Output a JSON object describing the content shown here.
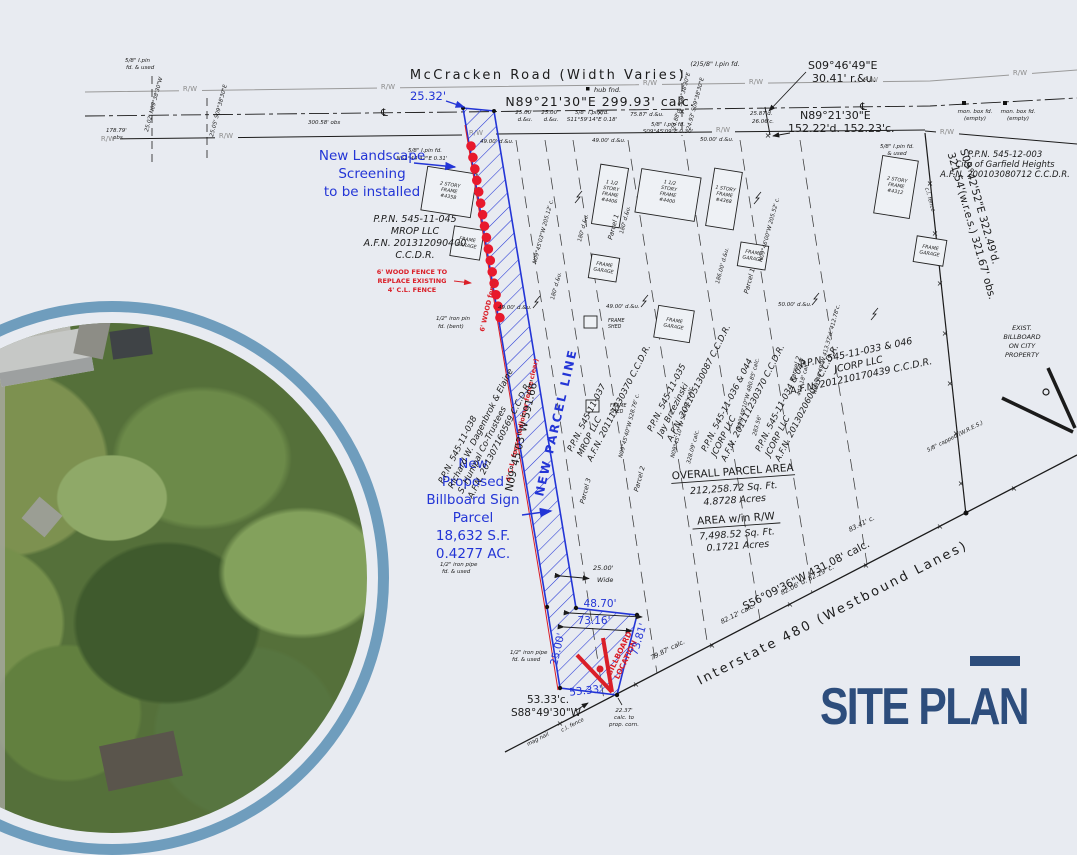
{
  "title": {
    "text": "SITE PLAN"
  },
  "road": {
    "name": "McCracken  Road  (Width Varies)",
    "bearing": "N89°21'30\"E  299.93' calc.",
    "rw": "R/W",
    "cl": "℄",
    "hub": "hub fnd.",
    "pin2": "(2)5/8\" I.pin fd.",
    "se1": "S09°46'49\"E",
    "se2": "30.41' r.&u.",
    "e1": "N89°21'30\"E",
    "e2": "152.22'd.  152.23'c.",
    "d25": "25.00'",
    "du": "d.&u.",
    "pin_s11": [
      "5/8\" I.pin fd.",
      "S11°59'14\"E 0.18'"
    ],
    "d7587": "75.87' d.&u.",
    "pin_s09": [
      "5/8\" I.pin fd.",
      "S09°45'09\"E 0.30'"
    ],
    "d2587": [
      "25.87'd.",
      "26.06'c."
    ],
    "r2488": "24.88'd. S09°38'30\"E",
    "r2493": "24.93' S09°38'30\"E",
    "d49": "49.00' d.&u.",
    "d50": "50.00' d.&u.",
    "pin_n51": [
      "5/8\" I.pin fd.",
      "N51°44'42\"E 0.31'"
    ],
    "mon": [
      "mon. box fd.",
      "(empty)"
    ],
    "pin_used": [
      "5/8\" I.pin fd.",
      "& used"
    ]
  },
  "left": {
    "pin": [
      "5/8\" I.pin",
      "fd. & used"
    ],
    "r2502": "25.02' N09°38'30\"W",
    "r2505": "25.05' S09°38'30\"E",
    "d17879": [
      "178.79'",
      "obs"
    ],
    "d30058": "300.58' obs"
  },
  "blue": {
    "d2532": "25.32'",
    "landscape": [
      "New Landscape",
      "Screening",
      "to be installed"
    ],
    "npl": "NEW PARCEL LINE",
    "proposed": [
      "New",
      "Proposed",
      "Billboard Sign",
      "Parcel",
      "18,632 S.F.",
      "0.4277 AC."
    ],
    "d4870": "48.70'",
    "d7316": "73.16'",
    "d7381": "73.81'",
    "d2500": "25.00'",
    "d5333": "53.33'"
  },
  "red": {
    "note": [
      "6' WOOD FENCE TO",
      "REPLACE EXISTING",
      "4' C.L. FENCE"
    ],
    "bb": [
      "BILLBOARD",
      "LOCATION"
    ],
    "f1": "6' WOOD fence",
    "f2": "4' C.L. fence (adjoiner fence clear)"
  },
  "parcels": {
    "p045": [
      "P.P.N. 545-11-045",
      "MROP LLC",
      "A.F.N. 201312090400",
      "C.C.D.R."
    ],
    "p038": [
      "P.P.N. 545-11-038",
      "Richard W. Dagenbrok & Elaine",
      "S. Humpal Co-Trustees",
      "A.F.N. 201307160569 C.C.D.R."
    ],
    "p037": [
      "P.P.N. 545-11-037",
      "MROP LLC",
      "A.F.N. 201111230370 C.C.D.R."
    ],
    "p035": [
      "P.P.N. 545-11-035",
      "Jay Brzezinski",
      "A.F.N. 201105130087 C.C.D.R."
    ],
    "p036": [
      "P.P.N. 545-11-036 & 044",
      "JCORP LLC",
      "A.F.N. 201111230370 C.C.D.R."
    ],
    "p034": [
      "P.P.N. 545-11-034 & 042",
      "JCORP LLC",
      "A.F.N. 201302060013 C.C.D.R."
    ],
    "p033": [
      "P.P.N. 545-11-033 & 046",
      "JCORP LLC",
      "A.F.N. 201210170439 C.C.D.R."
    ],
    "p003": [
      "P.P.N. 545-12-003",
      "City of Garfield Heights",
      "A.F.N. 200103080712 C.C.D.R."
    ],
    "parcel1": "Parcel 1",
    "parcel2": "Parcel 2",
    "parcel3": "Parcel 3"
  },
  "llabels": {
    "n0945_205": "N09°45'03\"W 205.12' c.",
    "d180": "180' d.&u.",
    "d186": "186.00' d.&u.",
    "n0946_205": "N09°46'00\"W 205.52' c.",
    "n0945_528": "N09°45'40\"W 528.76' c.",
    "n0945_534": "N09°45'10\"W 534.41' calc.",
    "c32809": "328.09' calc.",
    "n0949_480": "N09°49'10\"W 480.85' calc.",
    "n0946_413": "N09°46'49\"W 413.37'd. 412.78'c.",
    "c44318": "443.18' calc.",
    "c28356": "283.56'",
    "strip_bearing": "N09°45'03\"W  591.66'"
  },
  "areas": {
    "title": "OVERALL PARCEL AREA",
    "sqft": "212,258.72 Sq. Ft.",
    "acres": "4.8728 Acres",
    "rw_title": "AREA w/in R/W",
    "rw_sqft": "7,498.52 Sq. Ft.",
    "rw_acres": "0.1721 Acres"
  },
  "highway": {
    "name": "Interstate  480  (Westbound Lanes)",
    "bearing": "S56°09'36\"W  431.08' calc.",
    "t7987": "79.87' calc.",
    "t8212": "82.12' calc.",
    "t8206": "82.06' d.  82.29' c.",
    "t8341": "83.41' c."
  },
  "right": {
    "bearing1": "S09°42'52\"E  322.49'd.",
    "bearing2": "321.54'(w.r.e.s.)  321.67' obs.",
    "capped": "5/8\" capped (W.R.E.S.)",
    "exist": [
      "EXIST.",
      "BILLBOARD",
      "ON CITY",
      "PROPERTY"
    ]
  },
  "bottom": {
    "d5333c": "53.33'c.",
    "s88": "S88°49'30\"W",
    "mag": "mag nail",
    "clfence": "c.l. fence",
    "t2237": [
      "22.37'",
      "calc. to",
      "prop. corn."
    ],
    "pipe1": [
      "1/2\" iron pipe",
      "fd. & used"
    ],
    "pin_bent": [
      "1/2\" iron pin",
      "fd. (bent)"
    ],
    "d2500w": [
      "25.00'",
      "Wide"
    ]
  },
  "bld": {
    "h1": [
      "2 STORY",
      "FRAME",
      "#4358"
    ],
    "h2": [
      "1 1/2",
      "STORY",
      "FRAME",
      "#4406"
    ],
    "h3": [
      "1 1/2",
      "STORY",
      "FRAME",
      "#4400"
    ],
    "h4": [
      "1 STORY",
      "FRAME",
      "#4368"
    ],
    "h5": [
      "2 STORY",
      "FRAME",
      "#4312"
    ],
    "gar": [
      "FRAME",
      "GARAGE"
    ],
    "shed": [
      "FRAME",
      "SHED"
    ]
  },
  "colors": {
    "navy": "#2d4d7c",
    "blue": "#2335d6",
    "red": "#da1f28",
    "ring": "#6f9dbd",
    "bg": "#e8ebf1"
  }
}
